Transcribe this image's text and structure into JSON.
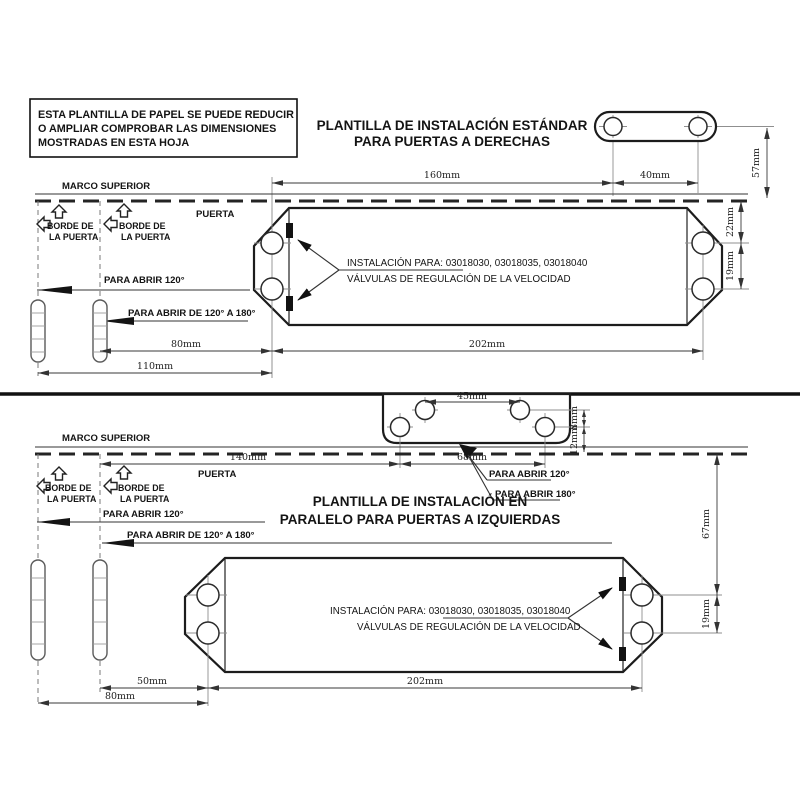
{
  "notice_box": {
    "line1": "ESTA PLANTILLA DE PAPEL SE PUEDE REDUCIR",
    "line2": "O AMPLIAR COMPROBAR LAS DIMENSIONES",
    "line3": "MOSTRADAS EN ESTA HOJA"
  },
  "shared_labels": {
    "marco_superior": "MARCO SUPERIOR",
    "puerta": "PUERTA",
    "borde_line1": "BORDE DE",
    "borde_line2": "LA PUERTA",
    "para_abrir_120": "PARA ABRIR 120°",
    "para_abrir_120_180": "PARA ABRIR DE 120° A 180°",
    "para_abrir_180": "PARA ABRIR 180°",
    "instalacion_para": "INSTALACIÓN PARA: 03018030, 03018035, 03018040",
    "valvulas": "VÁLVULAS DE REGULACIÓN DE LA VELOCIDAD"
  },
  "top_section": {
    "title_line1": "PLANTILLA DE INSTALACIÓN ESTÁNDAR",
    "title_line2": "PARA PUERTAS A DERECHAS",
    "dims": {
      "plate_to_bracket": "160mm",
      "bracket_holes": "40mm",
      "bracket_height": "57mm",
      "frame_to_hole": "22mm",
      "hole_spacing": "19mm",
      "hinge2_to_plate": "80mm",
      "hinge1_to_plate": "110mm",
      "plate_holes_span": "202mm"
    }
  },
  "bottom_section": {
    "title_line1": "PLANTILLA DE INSTALACIÓN EN",
    "title_line2": "PARALELO PARA PUERTAS A IZQUIERDAS",
    "dims": {
      "bracket_inner_holes": "45mm",
      "bracket_rows": "8mm",
      "bracket_to_frame": "12mm",
      "edge_to_bracket": "140mm",
      "bracket_outer_holes": "68mm",
      "frame_to_hole": "67mm",
      "hole_spacing": "19mm",
      "hinge2_to_plate": "50mm",
      "hinge1_to_plate": "80mm",
      "plate_holes_span": "202mm"
    }
  }
}
